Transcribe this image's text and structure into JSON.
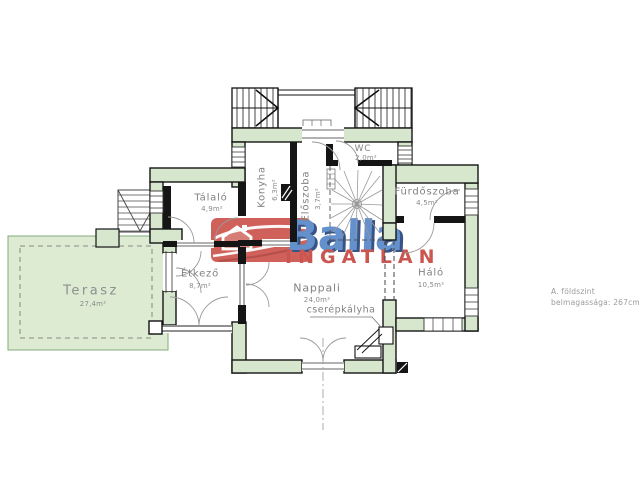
{
  "document": {
    "type": "floor-plan",
    "note_line1": "A. földszint",
    "note_line2": "belmagassága: 267cm"
  },
  "rooms": {
    "terasz": {
      "name": "Terasz",
      "area": "27,4m²"
    },
    "talalo": {
      "name": "Tálaló",
      "area": "4,9m²"
    },
    "konyha": {
      "name": "Konyha",
      "area": "6,3m²"
    },
    "eloszoba": {
      "name": "Előszoba",
      "area": "3,7m²"
    },
    "wc": {
      "name": "WC",
      "area": "2,0m²"
    },
    "furdoszoba": {
      "name": "Fürdőszoba",
      "area": "4,5m²"
    },
    "halo": {
      "name": "Háló",
      "area": "10,5m²"
    },
    "etkezo": {
      "name": "Étkező",
      "area": "8,7m²"
    },
    "nappali": {
      "name": "Nappali",
      "area": "24,0m²"
    }
  },
  "annotations": {
    "stove": "cserépkályha"
  },
  "watermark": {
    "brand": "Balla",
    "tagline": "INGATLAN"
  },
  "colors": {
    "wall_fill": "#d7e7cd",
    "wall_stroke": "#151515",
    "terrace_fill": "#dcebd2",
    "terrace_border": "#86a87c",
    "label_gray": "#828282",
    "logo_box_red": "#c94a42",
    "brand_blue": "#4e80c4",
    "brand_shadow_navy": "#1b3a74",
    "tagline_red": "#c43d36"
  }
}
